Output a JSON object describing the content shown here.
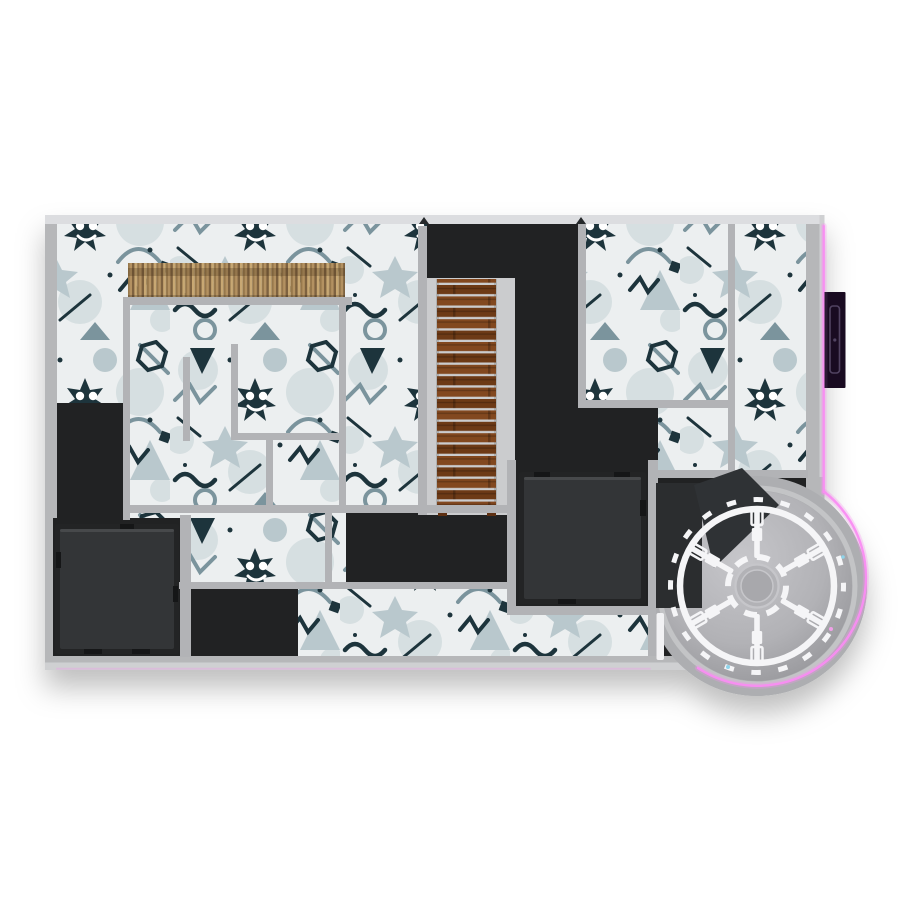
{
  "scene": {
    "title": "Top-down rendered floor plan of a doodle-themed game level",
    "view": "orthographic top-down",
    "rooms": [
      {
        "name": "upper-left doodle room",
        "floor": "doodle-pattern"
      },
      {
        "name": "bamboo-fence walkway",
        "floor": "doodle-pattern"
      },
      {
        "name": "inner maze rooms",
        "floor": "doodle-pattern"
      },
      {
        "name": "stair corridor",
        "floor": "light landing with wooden staircase"
      },
      {
        "name": "top-center dark hall",
        "floor": "black carpet"
      },
      {
        "name": "center dark room",
        "floor": "black carpet"
      },
      {
        "name": "left dark strip",
        "floor": "black carpet"
      },
      {
        "name": "bottom-left platform room",
        "floor": "black carpet with raised platform"
      },
      {
        "name": "center platform room",
        "floor": "black carpet with raised platform"
      },
      {
        "name": "upper-right doodle rooms",
        "floor": "doodle-pattern"
      },
      {
        "name": "bottom corridor",
        "floor": "doodle-pattern"
      },
      {
        "name": "circular turbine room",
        "floor": "gray disc with six-spoke wheel"
      }
    ],
    "features": {
      "staircase": {
        "material": "wood planks",
        "steps": 20,
        "orientation": "vertical"
      },
      "fence": {
        "material": "bamboo slats",
        "position": "upper-left"
      },
      "wheel": {
        "spokes": 6,
        "rings": 2,
        "tick_segments": 20
      },
      "platforms": 2,
      "neon_trim": "magenta strip along right exterior wall and circular bulge",
      "exterior_panel": "dark purple door panel on right exterior wall",
      "circular_room_door": "white door bar on west wall of circular room"
    }
  },
  "palette": {
    "page_bg": "#ffffff",
    "wall": "#b6b7b9",
    "wall_top": "#dcdde0",
    "wall_bottom_edge": "#cfd0d2",
    "wall_inner": "#b2b3b6",
    "floor_base": "#eceff0",
    "doodle_blob": "#d6dfe1",
    "doodle_light": "#b9c8cd",
    "doodle_mid": "#7b949d",
    "doodle_dark": "#1d343c",
    "white": "#ffffff",
    "carpet": "#212223",
    "carpet_deep": "#191a1b",
    "landing": "#cbccce",
    "platform_outer": "#232425",
    "platform": "#333537",
    "platform_highlight": "#47494b",
    "platform_tab": "#151617",
    "stair_wood": "#82481f",
    "stair_wood_dark": "#6d3a16",
    "stair_rail": "#a9aaac",
    "stair_foot": "#5e3012",
    "fence_a": "#c8a873",
    "fence_b": "#97784c",
    "fence_c": "#b39161",
    "fence_d": "#7e6240",
    "neon": "#f98df2",
    "panel": "#190b21",
    "panel_edge": "#2c1a35",
    "panel_line": "#514361",
    "bulge": "#adaeb1",
    "circle_rim": "#c3c4c6",
    "circle_floor_in": "#c6c6ca",
    "circle_floor_mid": "#b2b2b6",
    "circle_floor_out": "#8e8e92",
    "wheel": "#f5f5f7",
    "hub_fill": "#b2b2b6",
    "hub_disc": "#a8a8ac",
    "hub_disc_line": "#c6c6ca",
    "wedge": "#2f3235",
    "dark_annex": "#2b2d2f",
    "notch": "#25282a",
    "door_white": "#f2f2f4",
    "speck_cyan": "#8fd4ea",
    "speck_pink": "#f0a0e8",
    "shadow": "#000000"
  }
}
